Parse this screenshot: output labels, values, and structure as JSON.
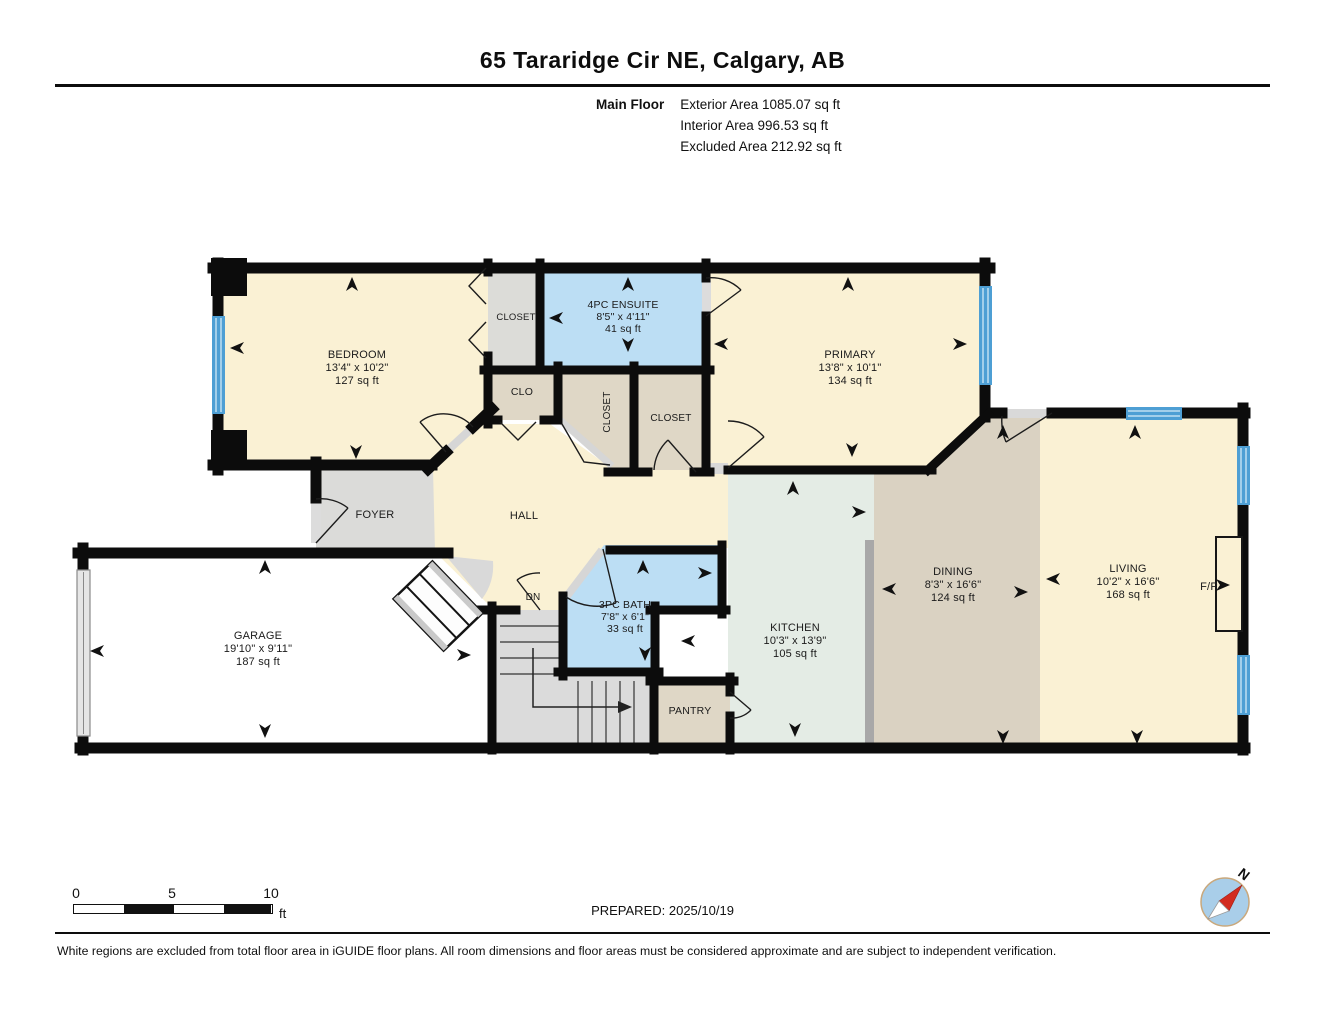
{
  "header": {
    "title": "65 Tararidge Cir NE, Calgary, AB",
    "floor_label": "Main Floor",
    "exterior": "Exterior Area 1085.07 sq ft",
    "interior": "Interior Area 996.53 sq ft",
    "excluded": "Excluded Area 212.92 sq ft"
  },
  "rooms": {
    "bedroom": {
      "name": "BEDROOM",
      "dims": "13'4\" x 10'2\"",
      "area": "127 sq ft"
    },
    "bedroom_closet": {
      "name": "CLOSET"
    },
    "ensuite": {
      "name": "4PC ENSUITE",
      "dims": "8'5\" x 4'11\"",
      "area": "41 sq ft"
    },
    "primary": {
      "name": "PRIMARY",
      "dims": "13'8\" x 10'1\"",
      "area": "134 sq ft"
    },
    "clo": {
      "name": "CLO"
    },
    "hall_closet": {
      "name": "CLOSET"
    },
    "primary_closet": {
      "name": "CLOSET"
    },
    "foyer": {
      "name": "FOYER"
    },
    "hall": {
      "name": "HALL"
    },
    "stairs_down": {
      "name": "DN"
    },
    "garage": {
      "name": "GARAGE",
      "dims": "19'10\" x 9'11\"",
      "area": "187 sq ft"
    },
    "bath": {
      "name": "3PC BATH",
      "dims": "7'8\" x 6'1\"",
      "area": "33 sq ft"
    },
    "pantry": {
      "name": "PANTRY"
    },
    "kitchen": {
      "name": "KITCHEN",
      "dims": "10'3\" x 13'9\"",
      "area": "105 sq ft"
    },
    "dining": {
      "name": "DINING",
      "dims": "8'3\" x 16'6\"",
      "area": "124 sq ft"
    },
    "living": {
      "name": "LIVING",
      "dims": "10'2\" x 16'6\"",
      "area": "168 sq ft"
    },
    "fireplace": {
      "name": "F/P"
    }
  },
  "scale_bar": {
    "labels": [
      "0",
      "5",
      "10"
    ],
    "unit": "ft"
  },
  "compass": {
    "label": "N"
  },
  "footer": {
    "prepared": "PREPARED: 2025/10/19",
    "disclaimer": "White regions are excluded from total floor area in iGUIDE floor plans. All room dimensions and floor areas must be considered approximate and are subject to independent verification."
  },
  "colors": {
    "wall": "#0c0c0c",
    "room_cream": "#FAF1D4",
    "room_tan": "#DFD7C6",
    "room_dining_tan": "#DAD2C2",
    "room_gray": "#DBDBD9",
    "room_blue": "#BCDEF4",
    "room_kitchen": "#E4ECE5",
    "window_blue": "#4E9FD4",
    "counter_gray": "#A8A8A8",
    "compass_fill": "#A9CEE9",
    "compass_needle": "#D22B1F"
  }
}
